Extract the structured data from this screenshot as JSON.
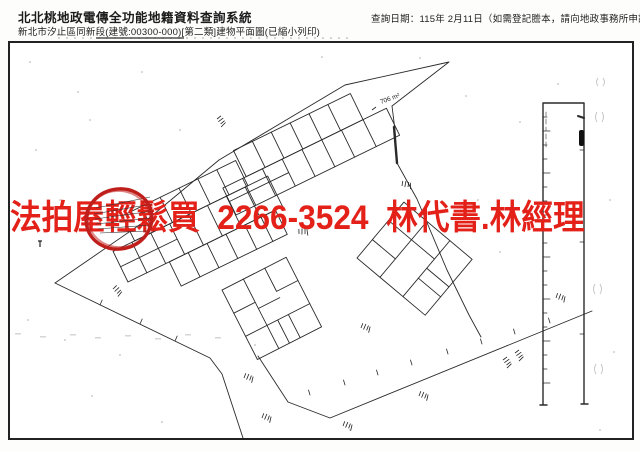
{
  "header": {
    "system_title": "北北桃地政電傳全功能地籍資料查詢系統",
    "subtitle": "新北市汐止區同新段(建號:00300-000)[第二類]建物平面圖(已縮小列印)",
    "query_date_note": "查詢日期：115年 2月11日（如需登記謄本，請向地政事務所申請。）"
  },
  "watermark": {
    "text": "法拍屋輕鬆買  2266-3524  林代書.林經理",
    "color": "#e32119"
  },
  "plan": {
    "area_label": "706 m²",
    "highlight_color": "#bf1f1b",
    "line_color": "#2a2a2a",
    "border_color": "#222222"
  }
}
